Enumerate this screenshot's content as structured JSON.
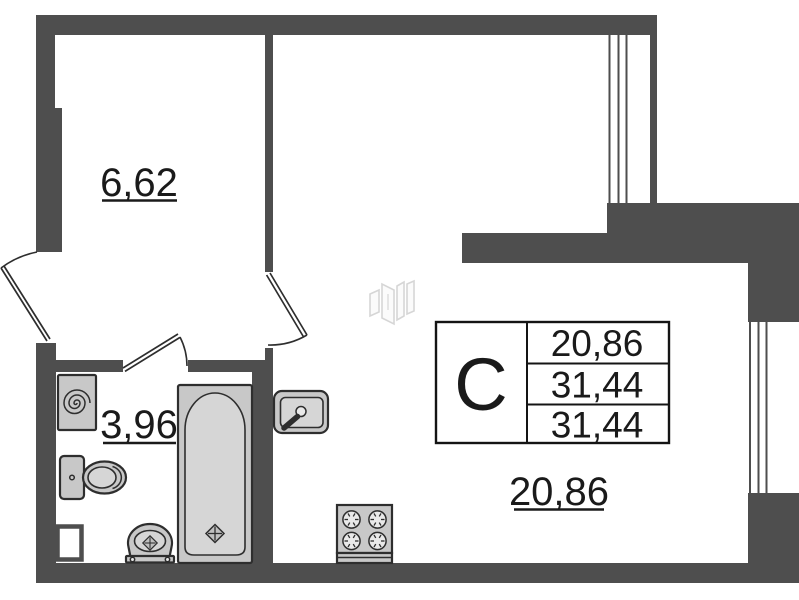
{
  "plan": {
    "room_labels": {
      "hallway": "6,62",
      "bathroom": "3,96",
      "living": "20,86"
    },
    "stamp": {
      "letter": "С",
      "values": [
        "20,86",
        "31,44",
        "31,44"
      ]
    },
    "colors": {
      "wall": "#4e4e4e",
      "line": "#2e2e2e",
      "fixture": "#c8c8c8",
      "text": "#1a1a1a"
    },
    "fixtures": [
      "washing-machine-icon",
      "toilet-icon",
      "bathtub-icon",
      "wash-basin-icon",
      "kitchen-sink-icon",
      "stove-icon",
      "vent-shaft",
      "window-top-icon",
      "window-right-icon",
      "door-entrance-icon",
      "door-living-icon",
      "door-bathroom-icon",
      "watermark-logo-icon"
    ]
  }
}
